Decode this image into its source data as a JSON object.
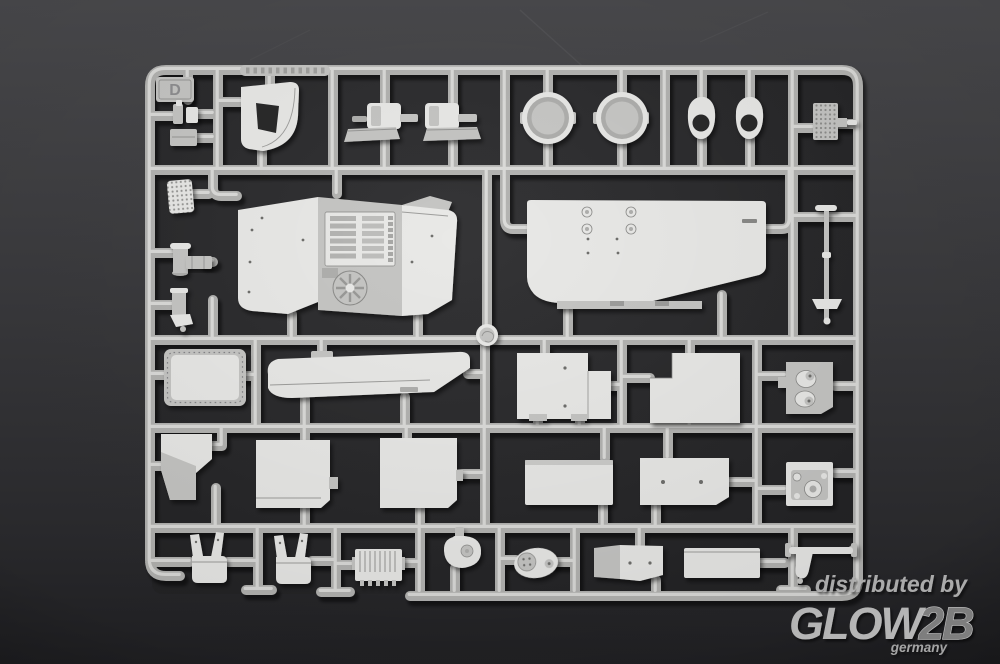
{
  "scene": {
    "caption": "Photograph of an injection-moulded model kit sprue (runner frame D) holding light grey styrene parts on a dark grey studio background"
  },
  "sprue": {
    "letter": "D"
  },
  "watermark": {
    "line1": "distributed by",
    "brand_glow": "GLOW",
    "brand_2b": "2B",
    "country": "germany"
  },
  "colors": {
    "background_top": "#4a4a4d",
    "background_bottom": "#212124",
    "sprue_interior": "#2a2a2c",
    "plastic_base": "#c6c6c4",
    "plastic_highlight": "#e9e9e7",
    "plastic_mid": "#b0b0ae",
    "plastic_shadow": "#8f8f8d",
    "runner_base": "#b4b4b2",
    "runner_highlight": "#e3e3e1",
    "watermark_text": "#b2b2b2"
  }
}
